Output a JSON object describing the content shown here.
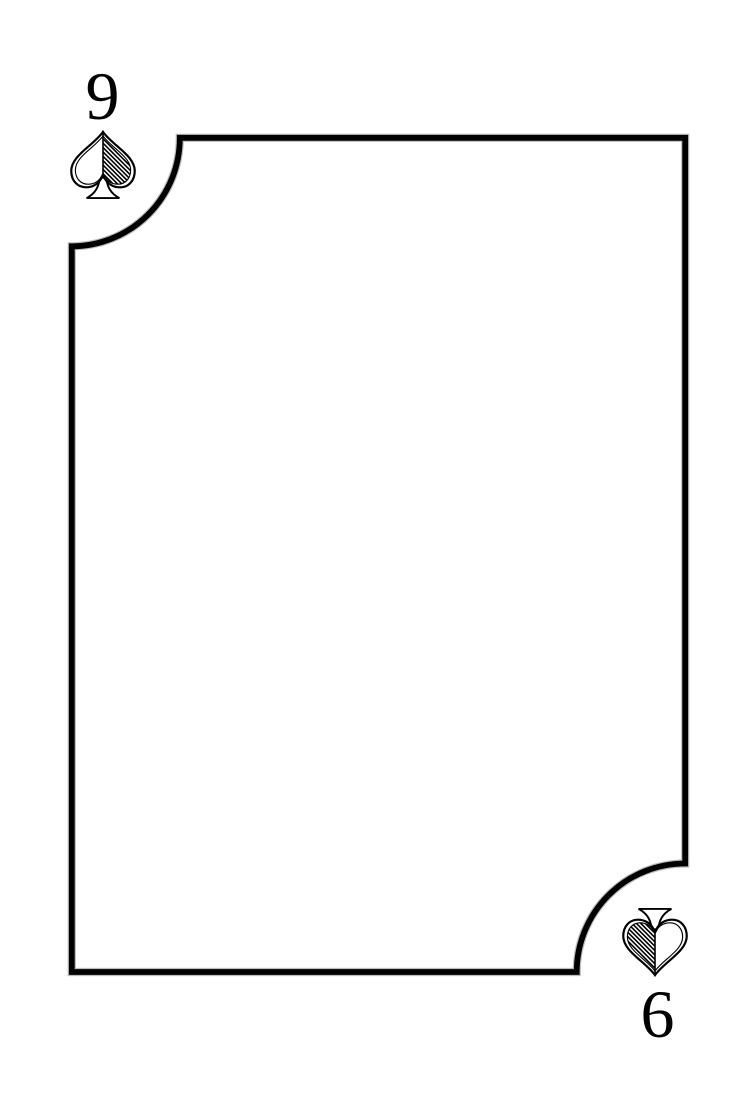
{
  "window": {
    "width": 756,
    "height": 1110,
    "background_color": "#ffffff"
  },
  "card": {
    "type": "playing-card-face",
    "face_color": "#ffffff",
    "border_color": "#000000",
    "inner_edge_color": "#bcbcbc",
    "suit_name": "spades",
    "suit_style": "outlined spade, right half filled with diagonal hatching, unfilled trapezoid stem",
    "corner_style": "concave quarter-circle cutouts at top-left and bottom-right; square corners at top-right and bottom-left",
    "top_left_index": {
      "rank": "9",
      "suit_icon": "spade-icon"
    },
    "bottom_right_index": {
      "rank": "6",
      "suit_icon": "spade-icon",
      "orientation": "rotated-180"
    }
  }
}
